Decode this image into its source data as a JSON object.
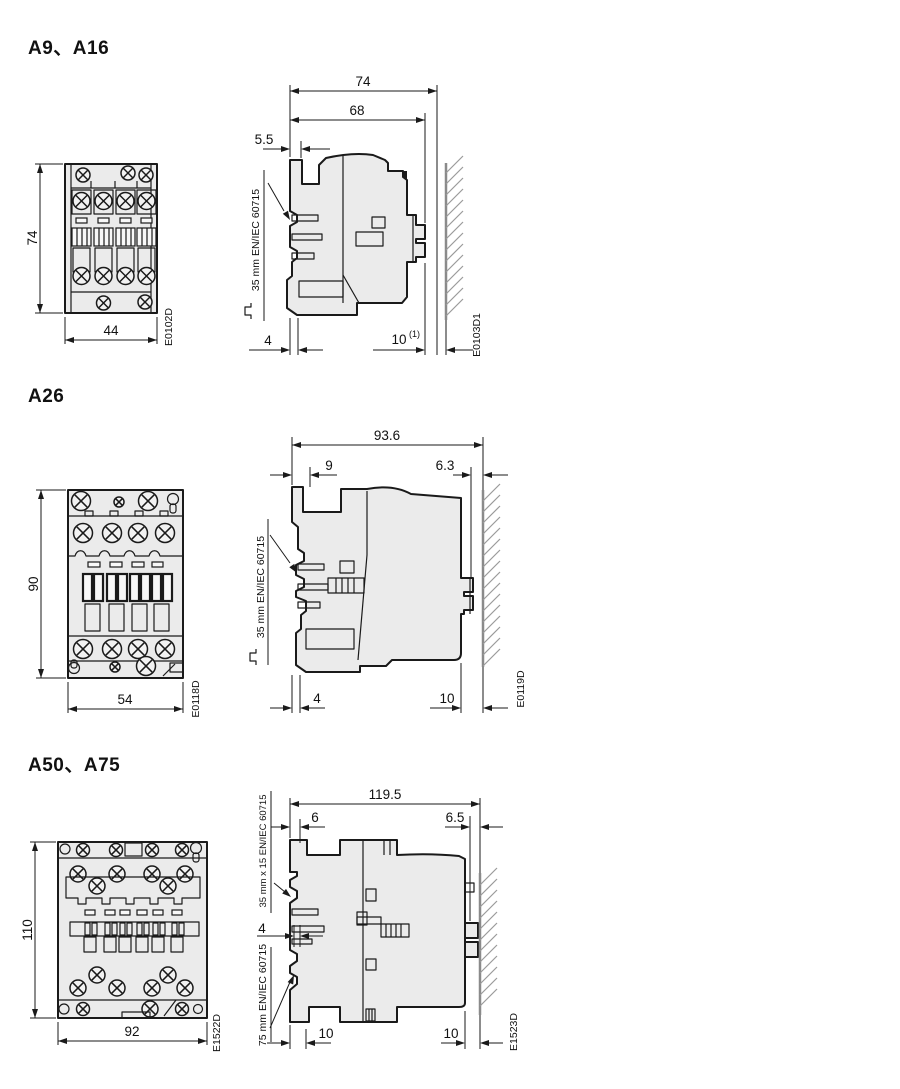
{
  "sections": [
    {
      "title": "A9、A16",
      "front": {
        "height": "74",
        "width": "44",
        "drawing_id": "E0102D"
      },
      "side": {
        "overall_depth": "74",
        "body_depth": "68",
        "front_tab_offset": "5.5",
        "din_rail_label": "35 mm EN/IEC 60715",
        "bottom_front_offset": "4",
        "wall_clearance": "10",
        "wall_clearance_note": "(1)",
        "drawing_id": "E0103D1"
      }
    },
    {
      "title": "A26",
      "front": {
        "height": "90",
        "width": "54",
        "drawing_id": "E0118D"
      },
      "side": {
        "overall_depth": "93.6",
        "front_tab_offset": "9",
        "rear_offset": "6.3",
        "din_rail_label": "35 mm EN/IEC 60715",
        "bottom_front_offset": "4",
        "wall_clearance": "10",
        "drawing_id": "E0119D"
      }
    },
    {
      "title": "A50、A75",
      "front": {
        "height": "110",
        "width": "92",
        "drawing_id": "E1522D"
      },
      "side": {
        "overall_depth": "119.5",
        "front_tab_offset": "6",
        "rear_offset": "6.5",
        "din_rail_top_label": "35 mm x 15 EN/IEC 60715",
        "din_rail_bottom_label": "75 mm EN/IEC 60715",
        "claw_offset": "4",
        "bottom_front_clearance": "10",
        "wall_clearance": "10",
        "drawing_id": "E1523D"
      }
    }
  ]
}
